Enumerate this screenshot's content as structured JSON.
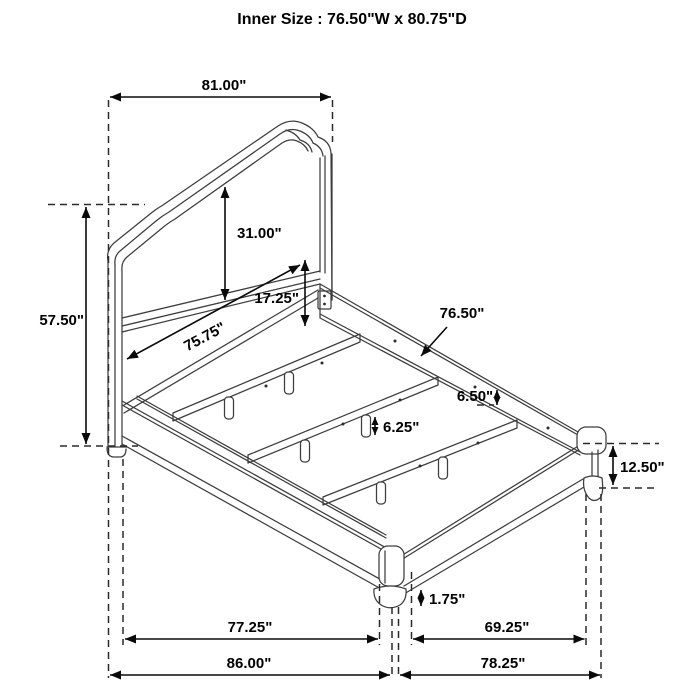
{
  "title": "Inner Size : 76.50\"W x 80.75\"D",
  "dims": {
    "headboard_width": "81.00\"",
    "headboard_height": "57.50\"",
    "headboard_panel_height": "31.00\"",
    "rail_drop": "17.25\"",
    "headboard_inner_width": "75.75\"",
    "slat_length": "76.50\"",
    "rail_to_ledge": "6.50\"",
    "center_leg_height": "6.25\"",
    "side_rail_height": "12.50\"",
    "foot_height": "1.75\"",
    "slat_frame_width": "77.25\"",
    "overall_width": "86.00\"",
    "side_rail_length": "69.25\"",
    "overall_depth": "78.25\""
  }
}
